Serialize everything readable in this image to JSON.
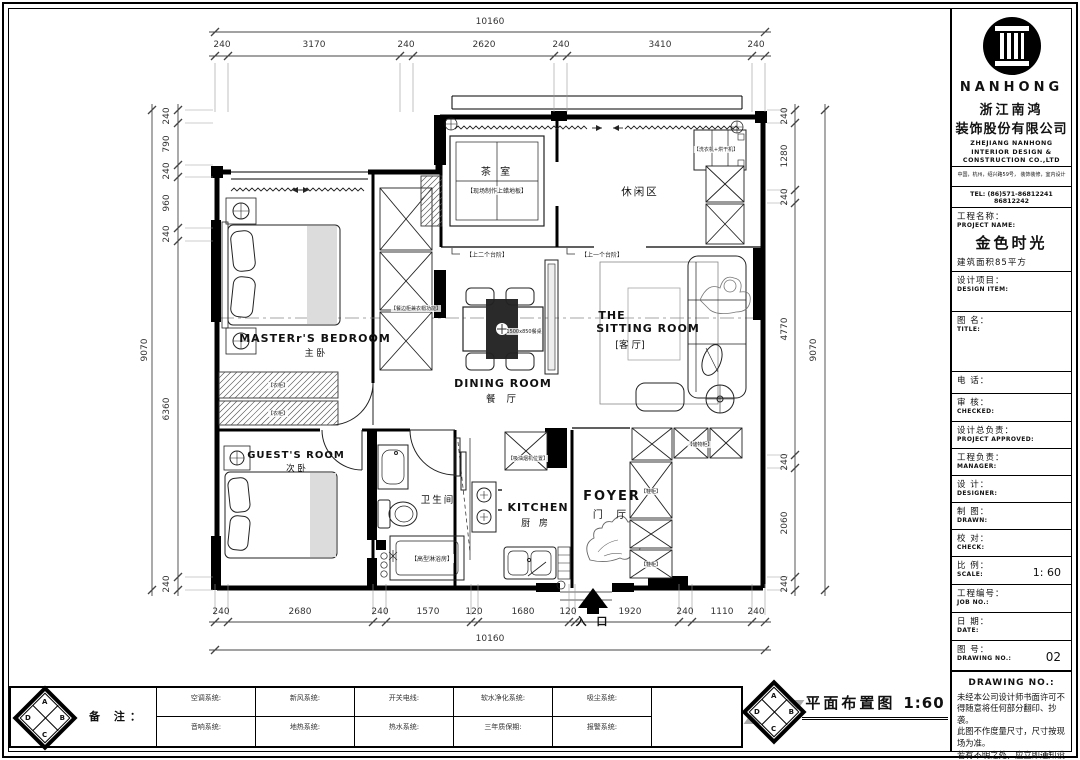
{
  "colors": {
    "line": "#1a1a1a",
    "wall": "#000000",
    "dim_text": "#333333",
    "paper": "#ffffff",
    "shade": "#d8d8d8"
  },
  "company": {
    "brand": "NANHONG",
    "name_cn_1": "浙江南鸿",
    "name_cn_2": "装饰股份有限公司",
    "name_en_1": "ZHEJIANG NANHONG",
    "name_en_2": "INTERIOR DESIGN &",
    "name_en_3": "CONSTRUCTION CO.,LTD",
    "address": "中国，杭州，绍兴路59号， 装饰装修，室内设计",
    "tel": "TEL:  (86)571-86812241  86812242"
  },
  "title_block": {
    "project_label_cn": "工程名称：",
    "project_label_en": "PROJECT NAME:",
    "project_name": "金色时光",
    "project_area": "建筑面积85平方",
    "design_item_cn": "设计项目：",
    "design_item_en": "DESIGN ITEM:",
    "title_cn": "图  名：",
    "title_en": "TITLE:",
    "tel_cn": "电    话：",
    "checked_cn": "审    核：",
    "checked_en": "CHECKED:",
    "approved_cn": "设计总负责：",
    "approved_en": "PROJECT APPROVED:",
    "manager_cn": "工程负责：",
    "manager_en": "MANAGER:",
    "designer_cn": "设    计：",
    "designer_en": "DESIGNER:",
    "drawn_cn": "制    图：",
    "drawn_en": "DRAWN:",
    "check_cn": "校    对：",
    "check_en": "CHECK:",
    "scale_cn": "比    例：",
    "scale_en": "SCALE:",
    "scale_value": "1: 60",
    "job_cn": "工程编号：",
    "job_en": "JOB  NO.:",
    "date_cn": "日    期：",
    "date_en": "DATE:",
    "no_cn": "图    号：",
    "no_en": "DRAWING NO.:",
    "no_value": "02",
    "footer_title": "DRAWING NO.:",
    "disclaimer_1": "未经本公司设计师书面许可不得随意将任何部分翻印、抄袭。",
    "disclaimer_2": "此图不作度量尺寸，尺寸按现场为准。",
    "disclaimer_3": "若有不明之处，应立即通知设计师。"
  },
  "plan": {
    "rooms": {
      "tea_name": "茶 室",
      "tea_note": "【现场制作上蜡地板】",
      "leisure_name": "休闲区",
      "laundry_note": "【洗衣机+烘干机】",
      "master_en": "MASTERr'S BEDROOM",
      "master_cn": "主    卧",
      "guest_en": "GUEST'S ROOM",
      "guest_cn": "次  卧",
      "bath_cn": "卫生间",
      "kitchen_en": "KITCHEN",
      "kitchen_cn": "厨 房",
      "dining_en": "DINING ROOM",
      "dining_cn": "餐 厅",
      "sitting_en_1": "THE",
      "sitting_en_2": "SITTING ROOM",
      "sitting_cn": "[客 厅]",
      "foyer_en": "FOYER",
      "foyer_cn": "门  厅",
      "entry": "入 口"
    },
    "notes": {
      "step_left": "【上二个台阶】",
      "step_right": "【上一个台阶】",
      "cabinet": "【餐边柜兼衣帽功能】",
      "wardrobe_1": "【衣柜】",
      "wardrobe_2": "【衣柜】",
      "hood": "【吸油烟机位置】",
      "shower": "【高型淋浴房】",
      "table": "1500x850餐桌",
      "storage": "【储物柜】",
      "shoe_1": "【鞋柜】",
      "shoe_2": "【鞋柜】"
    }
  },
  "dims": {
    "top": {
      "overall": "10160",
      "segments": [
        "240",
        "3170",
        "240",
        "2620",
        "240",
        "3410",
        "240"
      ]
    },
    "bottom": {
      "overall": "10160",
      "segments": [
        "240",
        "2680",
        "240",
        "1570",
        "120",
        "1680",
        "120",
        "1920",
        "240",
        "1110",
        "240"
      ]
    },
    "left": {
      "overall": "9070",
      "segments": [
        "240",
        "790",
        "240",
        "960",
        "240",
        "6360",
        "240"
      ]
    },
    "right": {
      "overall": "9070",
      "segments": [
        "240",
        "1280",
        "240",
        "4770",
        "240",
        "2060",
        "240"
      ]
    }
  },
  "footer": {
    "remark": "备 注：",
    "row1": [
      "空调系统:",
      "新风系统:",
      "开关电线:",
      "软水净化系统:",
      "吸尘系统:"
    ],
    "row2": [
      "音响系统:",
      "地热系统:",
      "热水系统:",
      "三年质保期:",
      "报警系统:"
    ],
    "drawing_title": "平面布置图",
    "drawing_scale": "1:60",
    "compass": [
      "A",
      "B",
      "C",
      "D"
    ]
  }
}
